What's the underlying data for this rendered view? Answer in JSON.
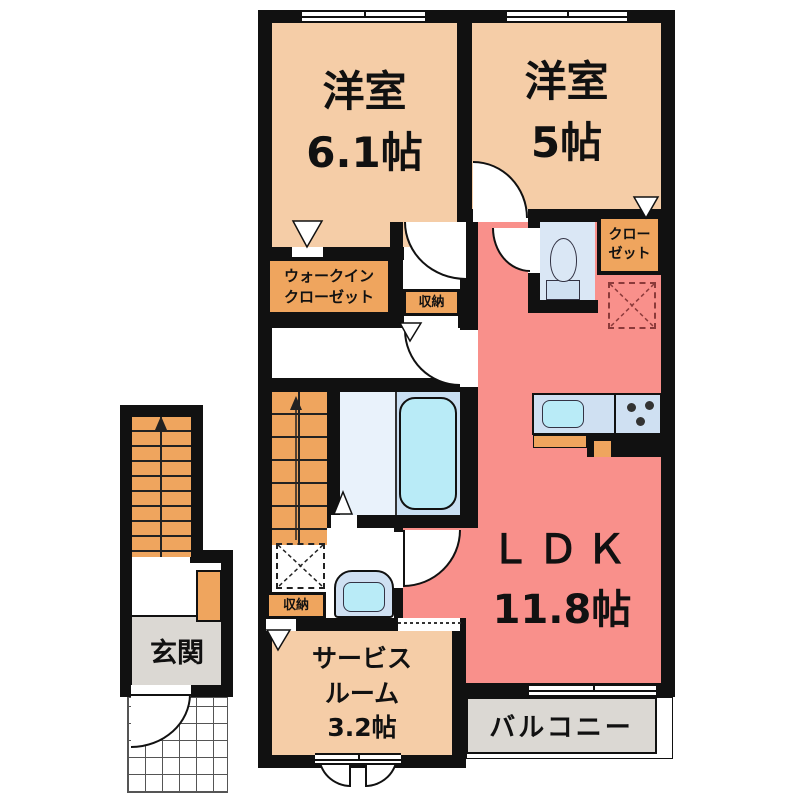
{
  "colors": {
    "wall": "#111111",
    "tan": "#F5CDA7",
    "salmon": "#F9908B",
    "orange": "#EFA55E",
    "bathFloor": "#E9F2FB",
    "tubZone": "#C9DFF2",
    "water": "#B9EBF7",
    "fixture": "#CFE0F2",
    "toiletFloor": "#DAE7F5",
    "gray": "#DBD8D3",
    "fridgeDash": "#8B3A3A"
  },
  "rooms": {
    "bedroom1": {
      "name": "洋室",
      "size": "6.1帖"
    },
    "bedroom2": {
      "name": "洋室",
      "size": "5帖"
    },
    "ldk": {
      "name": "ＬＤＫ",
      "size": "11.8帖"
    },
    "service_room": {
      "line1": "サービス",
      "line2": "ルーム",
      "line3": "3.2帖"
    },
    "entrance": {
      "name": "玄関"
    },
    "balcony": {
      "name": "バルコニー"
    }
  },
  "storage": {
    "walk_in_closet": {
      "line1": "ウォークイン",
      "line2": "クローゼット"
    },
    "closet": {
      "line1": "クロー",
      "line2": "ゼット"
    },
    "storage_hall": "収納",
    "storage_washroom": "収納"
  }
}
